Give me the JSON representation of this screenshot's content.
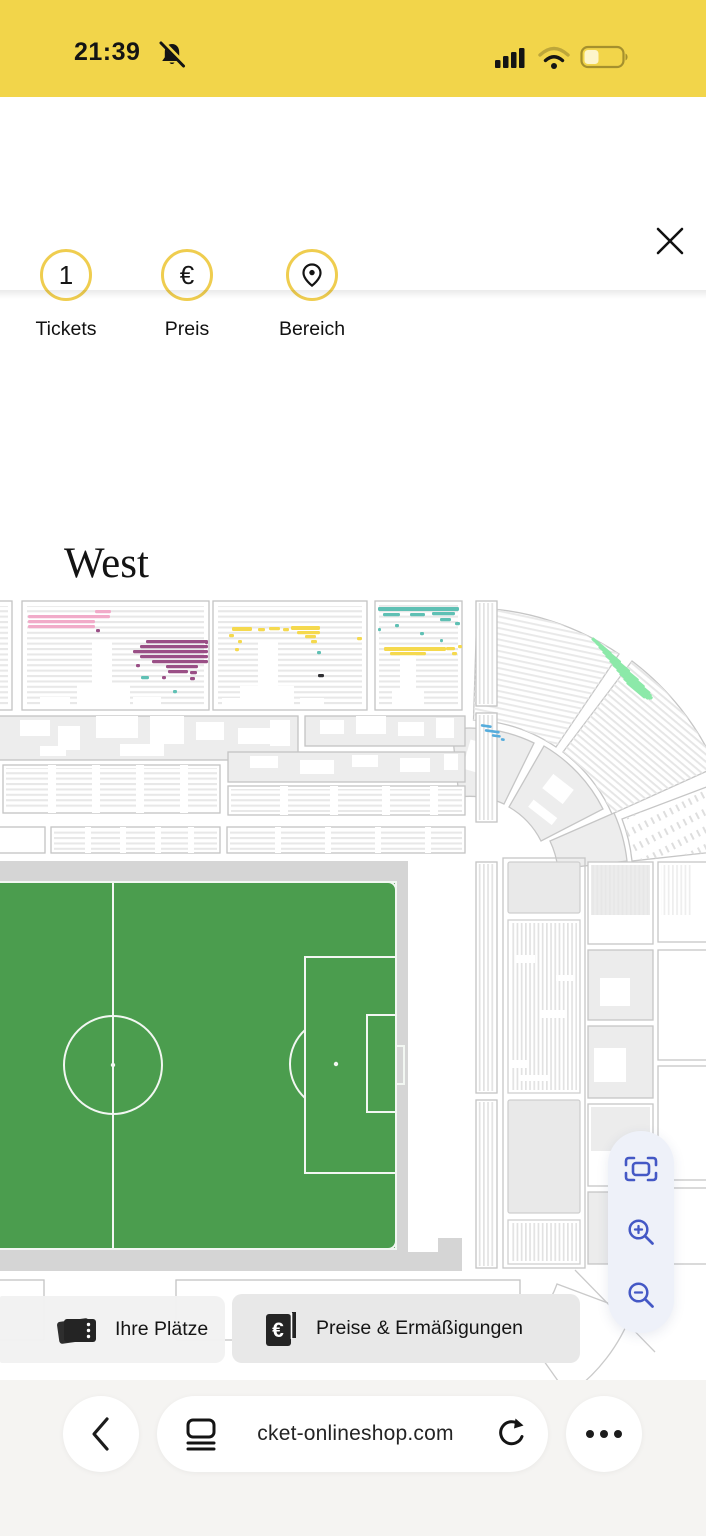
{
  "status_bar": {
    "time": "21:39",
    "icons": [
      "notifications-muted-icon",
      "cellular-signal-icon",
      "wifi-icon",
      "battery-icon"
    ]
  },
  "filter_header": {
    "close_icon": "close-icon",
    "items": [
      {
        "id": "tickets",
        "badge": "1",
        "label": "Tickets"
      },
      {
        "id": "preis",
        "badge": "€",
        "label": "Preis"
      },
      {
        "id": "bereich",
        "badge": "location-pin-icon",
        "label": "Bereich"
      }
    ]
  },
  "map": {
    "section_label": "West",
    "highlights": [
      {
        "x": 28,
        "y": 615,
        "w": 82,
        "c": "pink"
      },
      {
        "x": 28,
        "y": 620,
        "w": 67,
        "c": "pink"
      },
      {
        "x": 28,
        "y": 625,
        "w": 67,
        "c": "pink"
      },
      {
        "x": 95,
        "y": 610,
        "w": 16,
        "c": "pink"
      },
      {
        "x": 146,
        "y": 640,
        "w": 62,
        "c": "purple"
      },
      {
        "x": 140,
        "y": 645,
        "w": 68,
        "c": "purple"
      },
      {
        "x": 133,
        "y": 650,
        "w": 75,
        "c": "purple"
      },
      {
        "x": 140,
        "y": 655,
        "w": 68,
        "c": "purple"
      },
      {
        "x": 152,
        "y": 660,
        "w": 56,
        "c": "purple"
      },
      {
        "x": 166,
        "y": 665,
        "w": 32,
        "c": "purple"
      },
      {
        "x": 168,
        "y": 670,
        "w": 20,
        "c": "purple"
      },
      {
        "x": 190,
        "y": 671,
        "w": 7,
        "c": "purple"
      },
      {
        "x": 136,
        "y": 664,
        "w": 4,
        "c": "purple"
      },
      {
        "x": 162,
        "y": 676,
        "w": 4,
        "c": "purple"
      },
      {
        "x": 190,
        "y": 677,
        "w": 5,
        "c": "purple"
      },
      {
        "x": 205,
        "y": 641,
        "w": 3,
        "c": "purple"
      },
      {
        "x": 96,
        "y": 629,
        "w": 4,
        "c": "purple"
      },
      {
        "x": 141,
        "y": 676,
        "w": 8,
        "c": "teal"
      },
      {
        "x": 173,
        "y": 690,
        "w": 4,
        "c": "teal"
      },
      {
        "x": 232,
        "y": 627,
        "w": 20,
        "h": 4,
        "c": "yellow"
      },
      {
        "x": 258,
        "y": 628,
        "w": 7,
        "c": "yellow"
      },
      {
        "x": 269,
        "y": 627,
        "w": 11,
        "c": "yellow"
      },
      {
        "x": 283,
        "y": 628,
        "w": 6,
        "c": "yellow"
      },
      {
        "x": 291,
        "y": 626,
        "w": 29,
        "h": 4,
        "c": "yellow"
      },
      {
        "x": 297,
        "y": 631,
        "w": 23,
        "c": "yellow"
      },
      {
        "x": 305,
        "y": 635,
        "w": 11,
        "c": "yellow"
      },
      {
        "x": 229,
        "y": 634,
        "w": 5,
        "c": "yellow"
      },
      {
        "x": 238,
        "y": 640,
        "w": 4,
        "c": "yellow"
      },
      {
        "x": 311,
        "y": 640,
        "w": 6,
        "c": "yellow"
      },
      {
        "x": 357,
        "y": 637,
        "w": 5,
        "c": "yellow"
      },
      {
        "x": 235,
        "y": 648,
        "w": 4,
        "c": "yellow"
      },
      {
        "x": 317,
        "y": 651,
        "w": 4,
        "c": "teal"
      },
      {
        "x": 318,
        "y": 674,
        "w": 6,
        "c": "dark"
      },
      {
        "x": 378,
        "y": 607,
        "w": 81,
        "h": 4,
        "c": "teal"
      },
      {
        "x": 383,
        "y": 613,
        "w": 17,
        "c": "teal"
      },
      {
        "x": 410,
        "y": 613,
        "w": 15,
        "c": "teal"
      },
      {
        "x": 432,
        "y": 612,
        "w": 23,
        "c": "teal"
      },
      {
        "x": 440,
        "y": 618,
        "w": 11,
        "c": "teal"
      },
      {
        "x": 455,
        "y": 622,
        "w": 5,
        "c": "teal"
      },
      {
        "x": 395,
        "y": 624,
        "w": 4,
        "c": "teal"
      },
      {
        "x": 420,
        "y": 632,
        "w": 4,
        "c": "teal"
      },
      {
        "x": 378,
        "y": 628,
        "w": 3,
        "c": "teal"
      },
      {
        "x": 440,
        "y": 639,
        "w": 3,
        "c": "teal"
      },
      {
        "x": 384,
        "y": 647,
        "w": 62,
        "h": 4,
        "c": "yellow"
      },
      {
        "x": 390,
        "y": 652,
        "w": 36,
        "c": "yellow"
      },
      {
        "x": 446,
        "y": 647,
        "w": 9,
        "c": "yellow"
      },
      {
        "x": 452,
        "y": 652,
        "w": 5,
        "c": "yellow"
      },
      {
        "x": 458,
        "y": 645,
        "w": 4,
        "c": "yellow"
      },
      {
        "x": 593,
        "y": 637,
        "w": 25,
        "c": "green",
        "r": 40
      },
      {
        "x": 597,
        "y": 641,
        "w": 32,
        "c": "green",
        "r": 40
      },
      {
        "x": 600,
        "y": 645,
        "w": 40,
        "c": "green",
        "r": 40
      },
      {
        "x": 604,
        "y": 650,
        "w": 46,
        "c": "green",
        "r": 40
      },
      {
        "x": 607,
        "y": 654,
        "w": 50,
        "c": "green",
        "r": 40
      },
      {
        "x": 611,
        "y": 659,
        "w": 52,
        "c": "green",
        "r": 40
      },
      {
        "x": 614,
        "y": 663,
        "w": 50,
        "c": "green",
        "r": 40
      },
      {
        "x": 618,
        "y": 668,
        "w": 46,
        "c": "green",
        "r": 40
      },
      {
        "x": 621,
        "y": 672,
        "w": 40,
        "c": "green",
        "r": 40
      },
      {
        "x": 625,
        "y": 677,
        "w": 32,
        "c": "green",
        "r": 40
      },
      {
        "x": 628,
        "y": 681,
        "w": 24,
        "c": "green",
        "r": 40
      },
      {
        "x": 481,
        "y": 724,
        "w": 11,
        "h": 2.6,
        "c": "blue",
        "r": 8
      },
      {
        "x": 485,
        "y": 729,
        "w": 15,
        "h": 2.6,
        "c": "blue",
        "r": 8
      },
      {
        "x": 492,
        "y": 734,
        "w": 9,
        "h": 2.6,
        "c": "blue",
        "r": 8
      },
      {
        "x": 501,
        "y": 738,
        "w": 4,
        "h": 2.6,
        "c": "blue",
        "r": 8
      }
    ]
  },
  "action_buttons": [
    {
      "id": "your-seats",
      "icon": "tickets-stack-icon",
      "label": "Ihre Plätze"
    },
    {
      "id": "prices",
      "icon": "price-list-icon",
      "label": "Preise & Ermäßigungen"
    }
  ],
  "zoom_controls": [
    "fit-screen-icon",
    "zoom-in-icon",
    "zoom-out-icon"
  ],
  "browser_bar": {
    "url_text": "cket-onlineshop.com",
    "icons": [
      "back-chevron-icon",
      "reader-page-icon",
      "reload-icon",
      "more-ellipsis-icon"
    ]
  },
  "colors": {
    "status_bar_bg": "#F2D54A",
    "accent_ring": "#EFCD4F",
    "pitch_green": "#4B9D4E",
    "pitch_surround": "#D5D5D5",
    "zoom_icon_blue": "#4458C5",
    "zoom_pill_bg": "#EEF1F9",
    "highlight_pink": "#F1ABC9",
    "highlight_purple": "#9A4F86",
    "highlight_yellow": "#F5D94E",
    "highlight_teal": "#5FC0B4",
    "highlight_green": "#8CE9A9",
    "highlight_blue": "#55ACDC",
    "highlight_dark": "#2F2F33"
  }
}
